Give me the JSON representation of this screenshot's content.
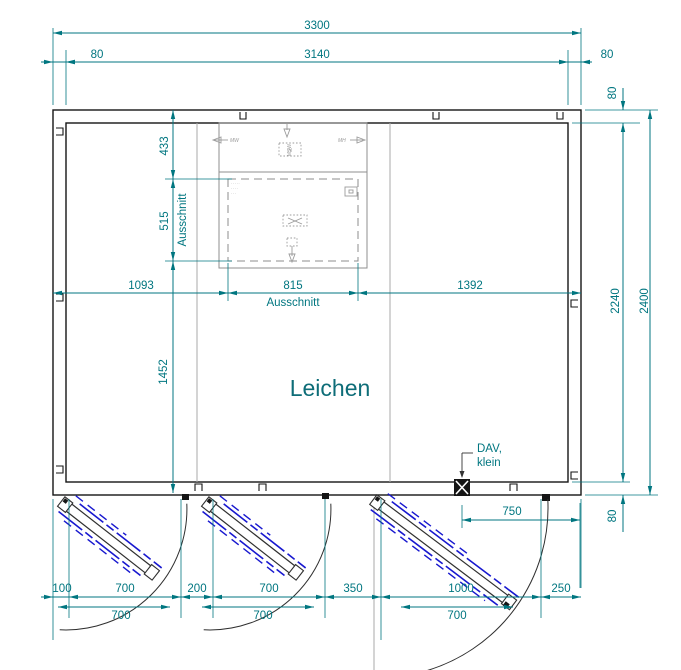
{
  "room": {
    "label": "Leichen"
  },
  "dims": {
    "top_overall": "3300",
    "top_inner": "3140",
    "top_wall_left": "80",
    "top_wall_right": "80",
    "right_wall_top": "80",
    "right_inner": "2240",
    "right_overall": "2400",
    "right_wall_bottom": "80",
    "left_chain": {
      "seg1": "433",
      "seg2": "515",
      "seg2_label": "Ausschnitt",
      "seg3": "1452"
    },
    "mid_chain": {
      "seg1": "1093",
      "seg2": "815",
      "seg2_label": "Ausschnitt",
      "seg3": "1392"
    },
    "bottom_row1": [
      "100",
      "700",
      "200",
      "700",
      "350",
      "1000",
      "250"
    ],
    "bottom_row2": [
      "700",
      "700",
      "700"
    ],
    "dav_offset": "750"
  },
  "callout": {
    "line1": "DAV,",
    "line2": "klein"
  },
  "tiny": {
    "left_arrow": "MW",
    "right_arrow": "MH",
    "top_arrow": "MSW",
    "dotted_box": "N",
    "note1": "·····",
    "note2": "····",
    "note3": "···"
  },
  "colors": {
    "dimension": "#007680",
    "wall": "#151515",
    "panel_gray": "#9b9b9b",
    "door_blue": "#1818cf",
    "room_label": "#0e6d78"
  }
}
